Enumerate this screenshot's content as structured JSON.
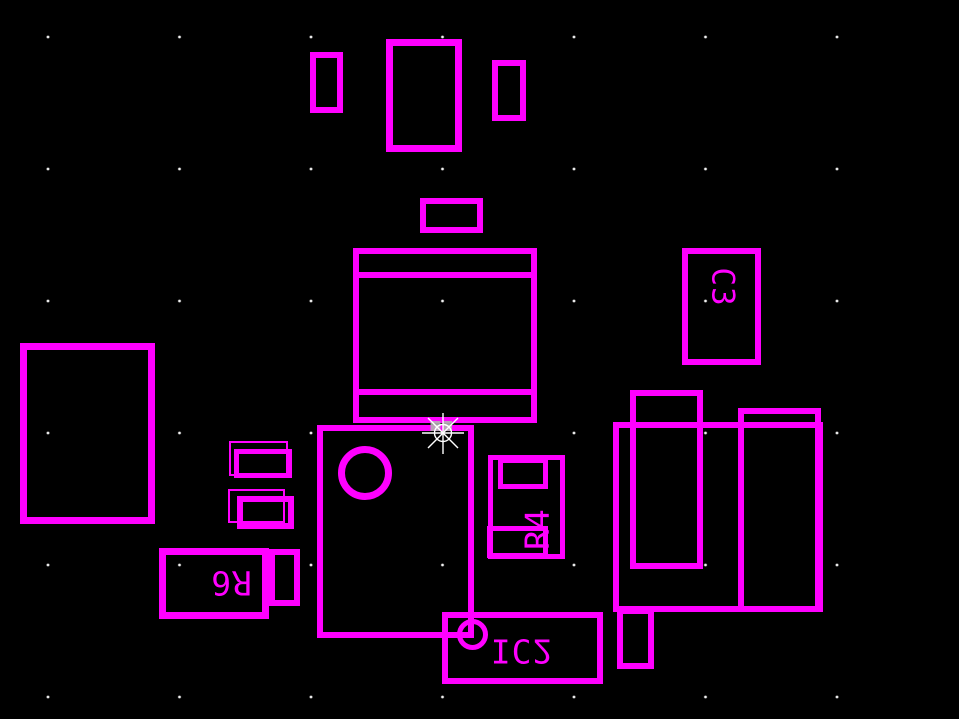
{
  "canvas": {
    "background_color": "#000000",
    "draw_color": "#ff00ff",
    "grid_dot_color": "#ffffff"
  },
  "cursor": {
    "style": "8-spoke star crosshair with circle and two gray selection handles",
    "color": "#ffffff",
    "handle_color": "#b3b3b3"
  },
  "components": {
    "c3": {
      "label": "C3"
    },
    "r4": {
      "label": "R4"
    },
    "r6": {
      "label": "R6"
    },
    "ic2": {
      "label": "IC2"
    }
  }
}
